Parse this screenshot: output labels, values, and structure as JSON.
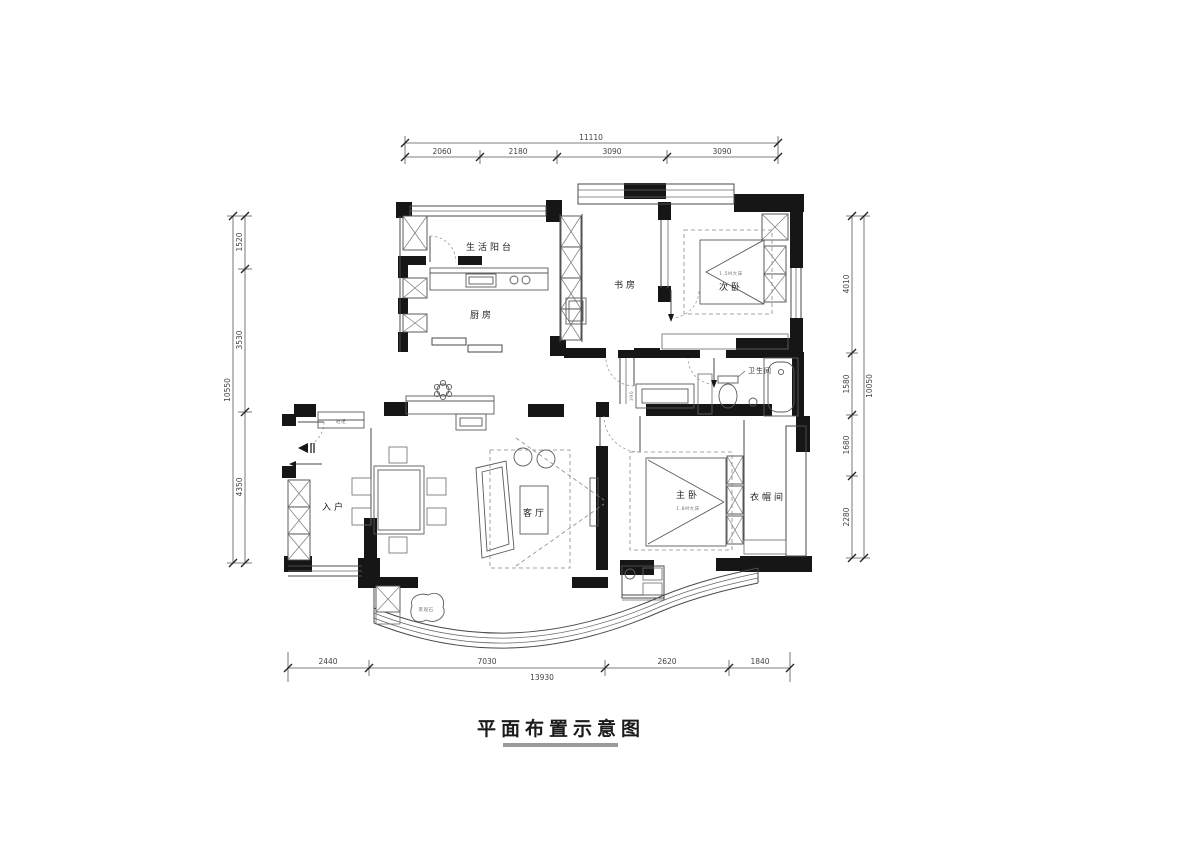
{
  "title": {
    "text": "平面布置示意图"
  },
  "dimensions": {
    "top": {
      "total": "11110",
      "segments": [
        "2060",
        "2180",
        "3090",
        "3090"
      ]
    },
    "bottom": {
      "total": "13930",
      "segments": [
        "2440",
        "7030",
        "2620",
        "1840"
      ]
    },
    "left": {
      "total": "10550",
      "segments": [
        "1520",
        "3530",
        "4350"
      ]
    },
    "right": {
      "total": "10050",
      "segments": [
        "4010",
        "1580",
        "1680",
        "2280"
      ]
    }
  },
  "rooms": {
    "service_balcony": "生活阳台",
    "kitchen": "厨房",
    "study": "书房",
    "second_bedroom": "次卧",
    "bathroom": "卫生间",
    "master_bedroom": "主卧",
    "cloakroom": "衣帽间",
    "entry": "入户",
    "living_room": "客厅"
  },
  "annotations": {
    "second_bed_size": "1.5M大床",
    "master_bed_size": "1.8M大床",
    "shoe_cabinet": "鞋柜",
    "landscape_stone": "景观石",
    "niche_width": "390"
  }
}
